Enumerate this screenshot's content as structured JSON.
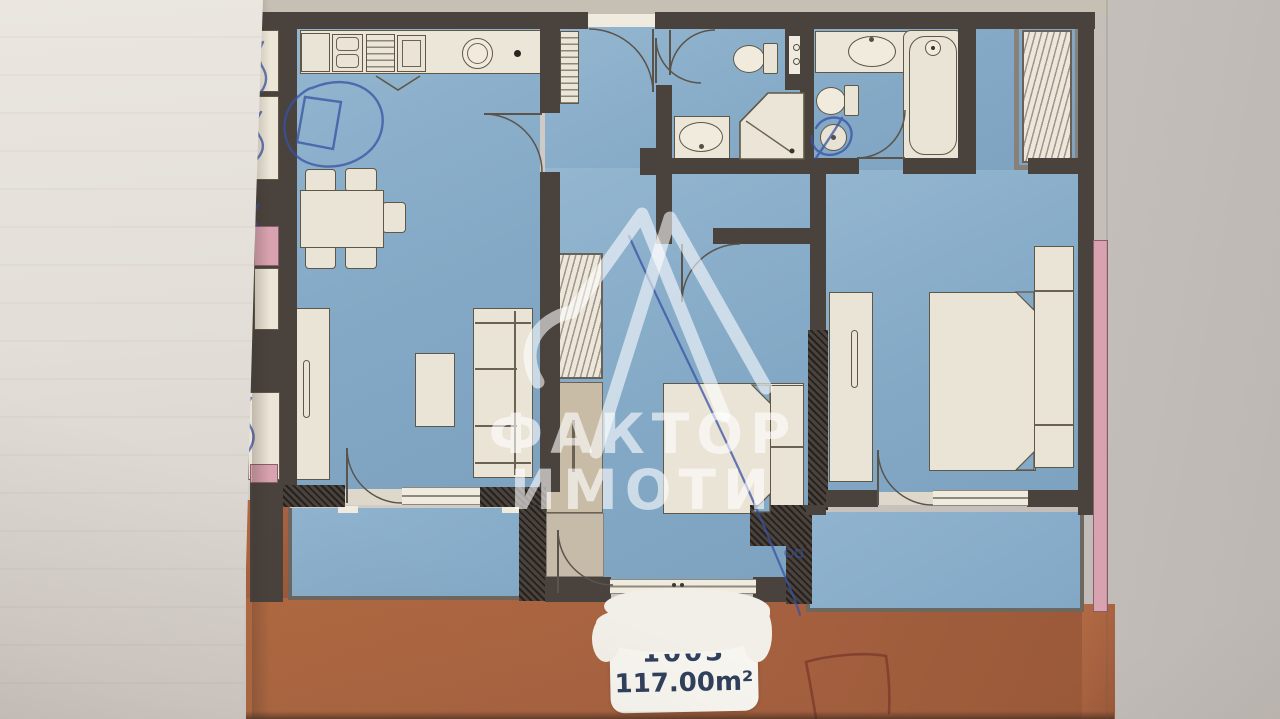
{
  "image_type": "photograph of an apartment floor plan sheet, partly covered by a white sheet of paper, stamped with a real-estate agency watermark",
  "watermark": {
    "logo": "faktor-imoti-monogram-icon",
    "brand_line1": "ФАКТОР",
    "brand_line2": "ИМОТИ",
    "color": "#ffffff",
    "opacity": 0.6
  },
  "area_label": {
    "unit_number_partial_visible": "1003",
    "area_text": "117.00m²",
    "text_color": "#30405c",
    "note": "top line half-worn away by scratched white paint"
  },
  "colors": {
    "room_floor_blue": "#84aac7",
    "terrace_orange": "#a66140",
    "wall_dark": "#49423d",
    "furniture_cream": "#eae4d6",
    "pink_accent": "#d9a2b0",
    "pen_blue": "#3752a4",
    "pen_red_brown": "#7c3c2c",
    "paper_white": "#e6e1db",
    "photo_background": "#cdc7c2"
  },
  "rooms": [
    "kitchen-dining-living-room",
    "entrance-hall",
    "bathroom-small-with-shower",
    "bathroom-large-with-bathtub",
    "bedroom-middle",
    "bedroom-right",
    "balcony-left",
    "balcony-right",
    "roof-terrace"
  ],
  "fixtures": [
    "kitchen-counter",
    "kitchen-double-sink",
    "kitchen-stove",
    "kitchen-oven",
    "kitchen-round-sink",
    "dining-table-with-5-chairs",
    "tall-cabinet",
    "coffee-table",
    "sofa",
    "hall-radiator",
    "hall-shelf-closet-hatched",
    "toilet-small-bath",
    "corner-shower",
    "washbasin-small-bath",
    "service-shaft",
    "washbasin-large-bath",
    "toilet-large-bath",
    "bathtub",
    "floor-drain",
    "wardrobe-niche-hatched",
    "double-bed-middle",
    "double-bed-right",
    "wardrobe-middle-bedroom",
    "wardrobe-right-bedroom",
    "sliding-terrace-door"
  ],
  "pen_annotations": [
    "blue-pen-oval-and-box-over-kitchen",
    "blue-pen-squiggles-on-left-neighbour-strip",
    "blue-pen-long-curved-line-through-middle-bedroom",
    "blue-pen-scribble-over-bathroom-floor-drain",
    "red-pen-open-rectangle-on-terrace"
  ]
}
